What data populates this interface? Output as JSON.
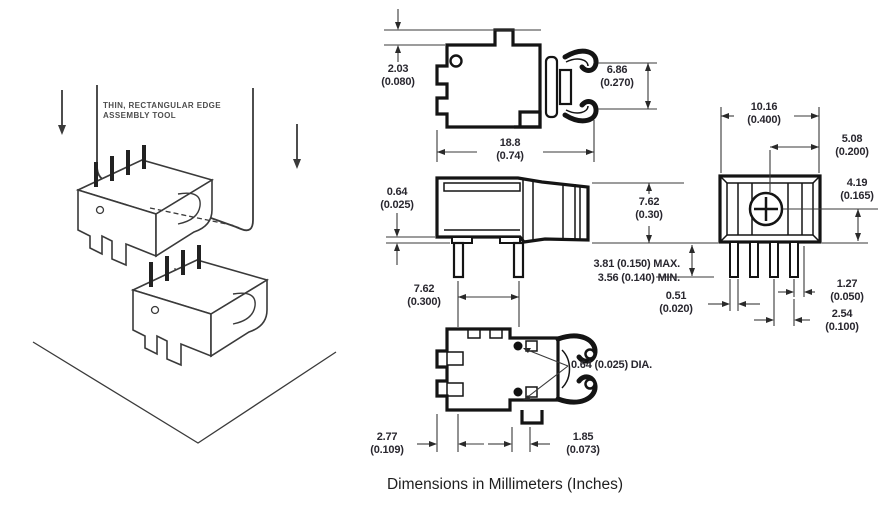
{
  "page": {
    "caption": "Dimensions in Millimeters (Inches)"
  },
  "illustration": {
    "tool_label": "THIN, RECTANGULAR EDGE\nASSEMBLY TOOL"
  },
  "dimensions": {
    "top_view": {
      "tab_height": "2.03\n(0.080)",
      "tip_gap": "6.86\n(0.270)",
      "overall_width": "18.8\n(0.74)"
    },
    "side_view": {
      "standoff_height": "0.64\n(0.025)",
      "body_height": "7.62\n(0.30)",
      "pin_length": "3.81 (0.150) MAX.\n3.56 (0.140) MIN.",
      "pin_spacing": "7.62\n(0.300)"
    },
    "bottom_view": {
      "edge_to_pin": "2.77\n(0.109)",
      "pin_to_contact": "1.85\n(0.073)",
      "contact_dia": "0.64 (0.025) DIA."
    },
    "front_view": {
      "body_width": "10.16\n(0.400)",
      "center_to_edge": "5.08\n(0.200)",
      "contact_height": "4.19\n(0.165)",
      "pin_width": "0.51\n(0.020)",
      "pin_edge_gap": "1.27\n(0.050)",
      "pin_pitch": "2.54\n(0.100)"
    }
  },
  "colors": {
    "background": "#ffffff",
    "drawing_line": "#1c1c1c",
    "dimension_line": "#3a3a3a",
    "text": "#29272f",
    "illustration_line": "#3a3a3a"
  }
}
